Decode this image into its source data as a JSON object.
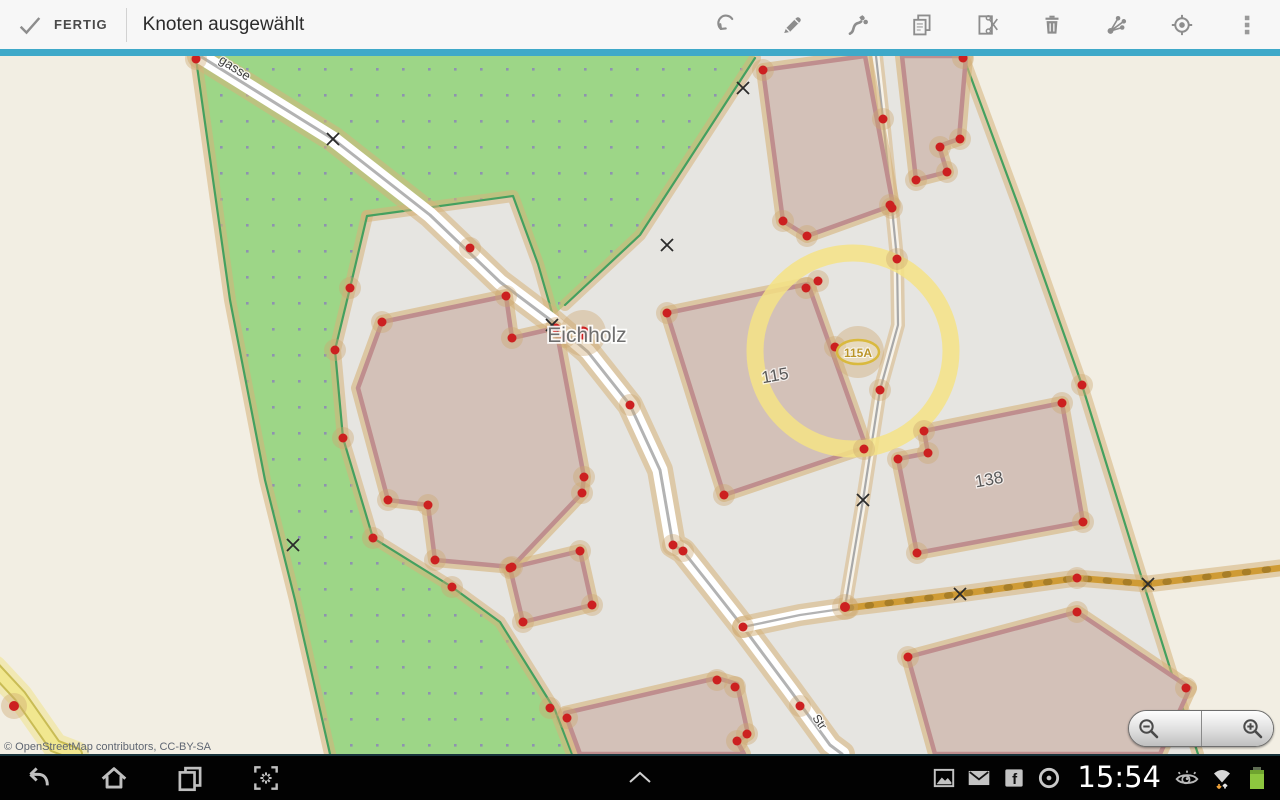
{
  "action_bar": {
    "done_label": "FERTIG",
    "title": "Knoten ausgewählt",
    "tool_icons": [
      "undo-icon",
      "edit-tags-icon",
      "extract-node-icon",
      "copy-icon",
      "cut-icon",
      "delete-icon",
      "relation-icon",
      "gps-follow-icon",
      "overflow-menu-icon"
    ]
  },
  "map": {
    "labels": {
      "place": "Eichholz",
      "housenumber_115": "115",
      "housenumber_138": "138",
      "housenumber_badge": "115A",
      "street_top": "gasse",
      "street_bottom": "Str"
    },
    "attribution": "© OpenStreetMap contributors, CC-BY-SA",
    "status": "node selected (yellow halo ring)",
    "colors": {
      "accent_underline": "#3fa9c9",
      "scrub_green": "#9dd687",
      "landuse_gray": "#e6e5e1",
      "background_beige": "#f2eee3",
      "building_fill": "#d3c1b8",
      "building_outline": "#bf8e8e",
      "way_highlight": "#d6b27a",
      "node_red": "#cc2020",
      "selection_yellow": "#f4e385",
      "track_orange": "#cf9b35",
      "road_yellow": "#f1e78f"
    },
    "zoom_icons": [
      "zoom-out-icon",
      "zoom-in-icon"
    ]
  },
  "system_bar": {
    "time": "15:54",
    "facebook_glyph": "f",
    "nav_icons": [
      "back-icon",
      "home-icon",
      "recent-apps-icon",
      "screenshot-icon",
      "expand-tray-chevron-icon"
    ],
    "status_icons": [
      "gallery-icon",
      "email-icon",
      "facebook-icon",
      "clock-icon",
      "smart-stay-eye-icon",
      "wifi-icon",
      "battery-icon"
    ]
  }
}
